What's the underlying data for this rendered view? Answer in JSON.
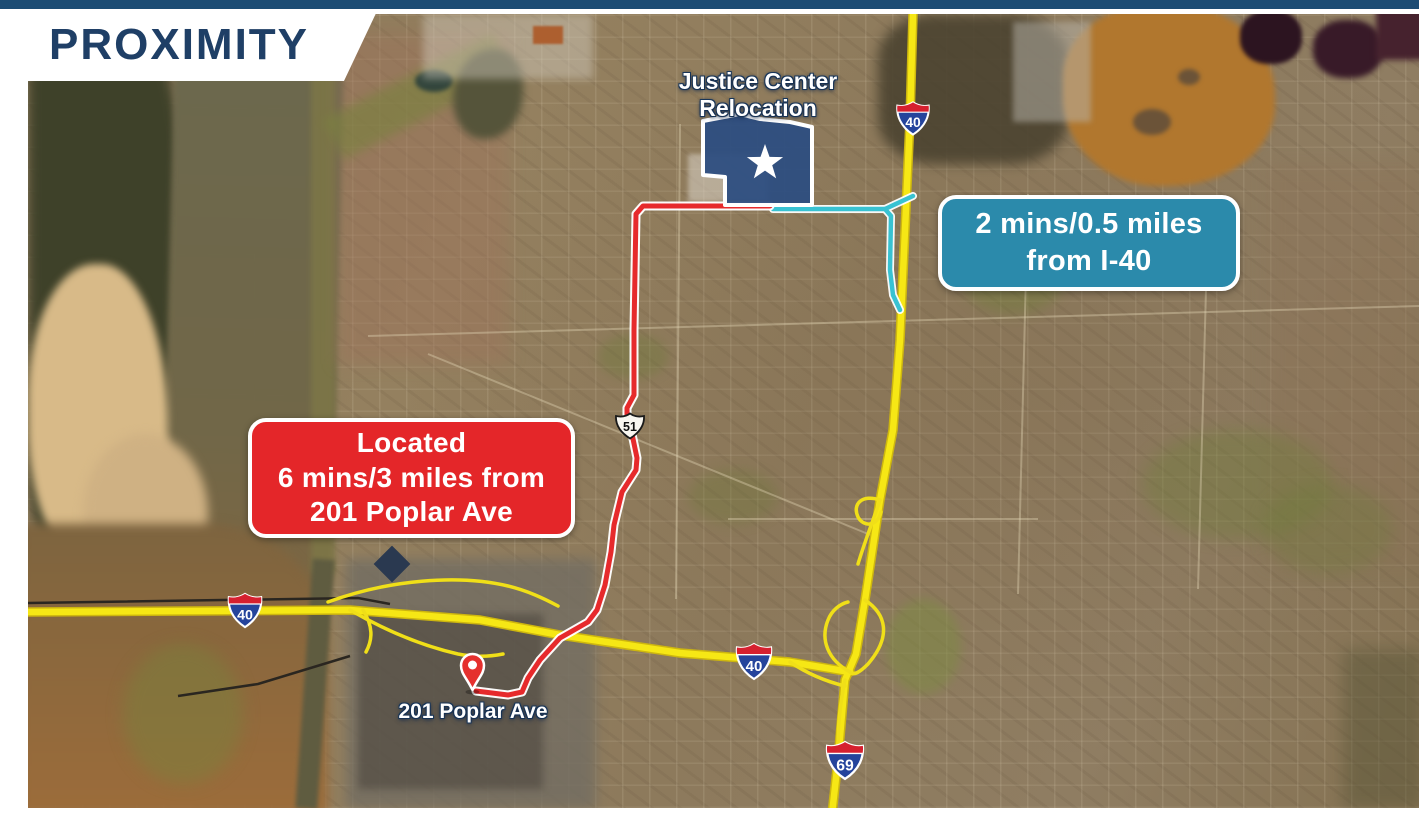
{
  "slide": {
    "title": "PROXIMITY",
    "top_bar_color": "#1c4c74",
    "title_color": "#1f3f66"
  },
  "map": {
    "site_label": {
      "line1": "Justice Center",
      "line2": "Relocation"
    },
    "pin_label": "201 Poplar Ave",
    "callout_i40": {
      "line1": "2 mins/0.5 miles",
      "line2": "from I-40",
      "bg_color": "#2b8aab"
    },
    "callout_poplar": {
      "line1": "Located",
      "line2": "6 mins/3 miles from",
      "line3": "201 Poplar Ave",
      "bg_color": "#e42629"
    },
    "shields": {
      "i40_north": "40",
      "i40_bridge": "40",
      "i40_mid": "40",
      "i69": "69",
      "us51": "51"
    },
    "colors": {
      "highway_yellow": "#f6e715",
      "route_to_downtown": "#e62a2c",
      "route_to_i40": "#38c2d2",
      "site_polygon": "#2d4e81",
      "pin_red": "#e5302e"
    }
  }
}
